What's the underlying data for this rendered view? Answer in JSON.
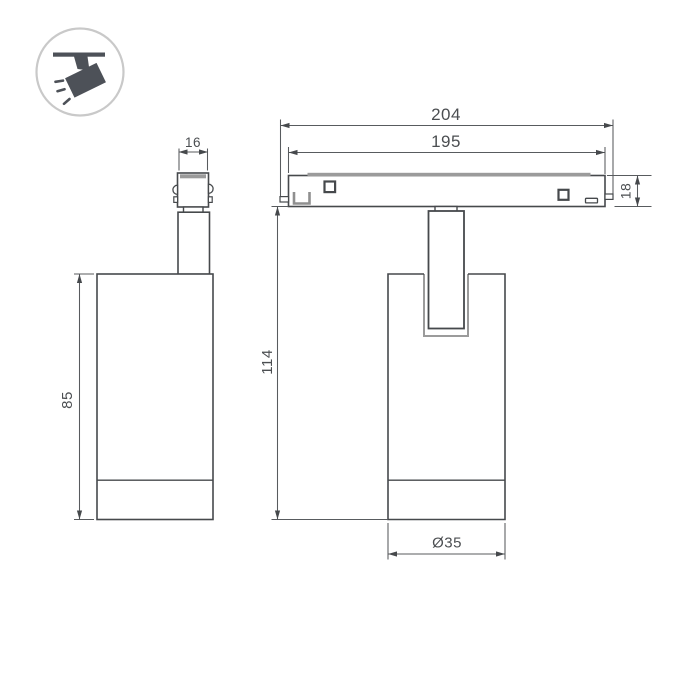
{
  "drawing": {
    "type": "technical-dimension-drawing",
    "subject": "magnetic-track-spotlight",
    "background_color": "#ffffff",
    "line_color": "#46494c",
    "dimension_line_color": "#585b5e",
    "accent_gray": "#9b9b9b",
    "text_color": "#4b4e51"
  },
  "icon": {
    "name": "ceiling-track-spotlight-icon",
    "shape_color": "#4d5158",
    "border_color": "#c9c9c9"
  },
  "dims": {
    "adapter_width": "16",
    "body_height": "85",
    "track_overall": "204",
    "track_inner": "195",
    "track_height": "18",
    "overall_height": "114",
    "diameter": "Ø35"
  }
}
